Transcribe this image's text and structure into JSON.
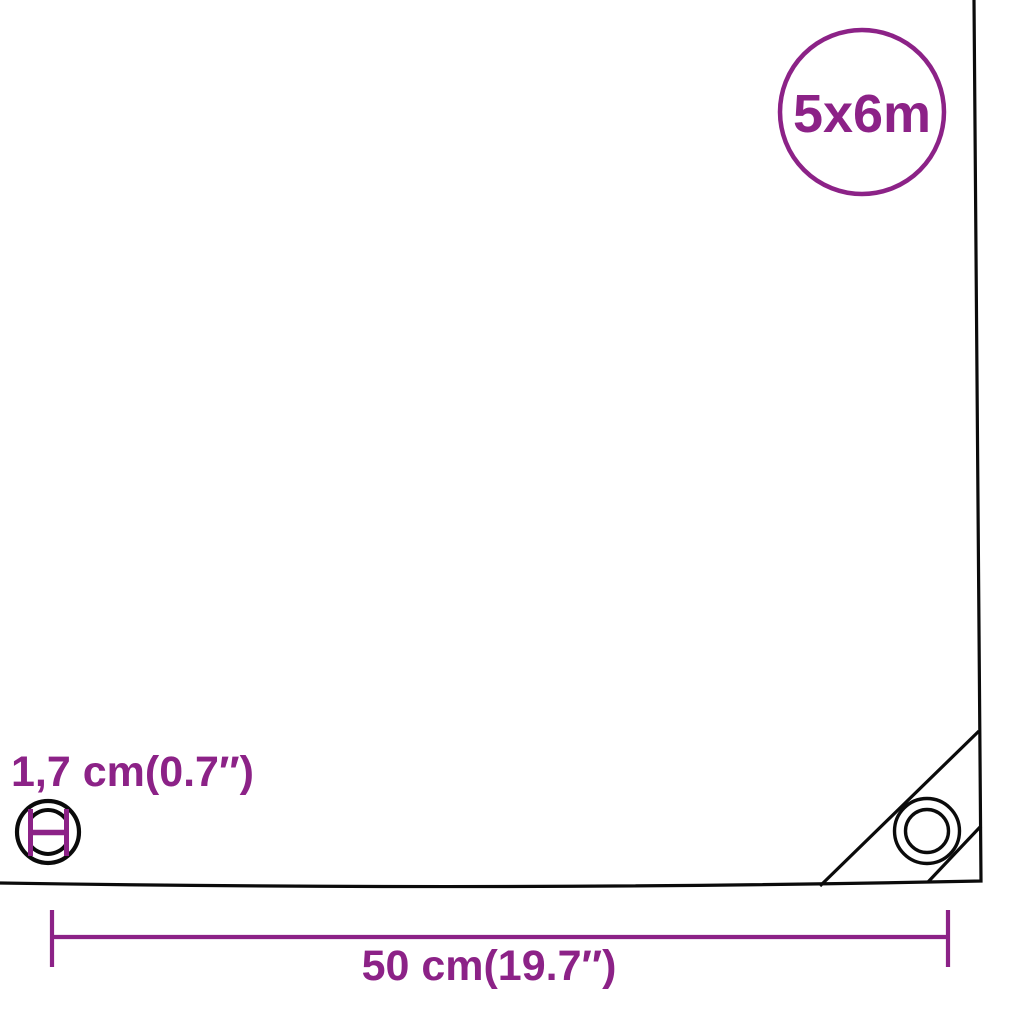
{
  "diagram": {
    "size_badge": {
      "label": "5x6m"
    },
    "eyelet": {
      "diameter_label": "1,7 cm(0.7″)"
    },
    "edge_dimension": {
      "label": "50 cm(19.7″)"
    }
  },
  "colors": {
    "accent": "#8C2287",
    "outline": "#0B0B0B",
    "background": "#FFFFFF"
  }
}
